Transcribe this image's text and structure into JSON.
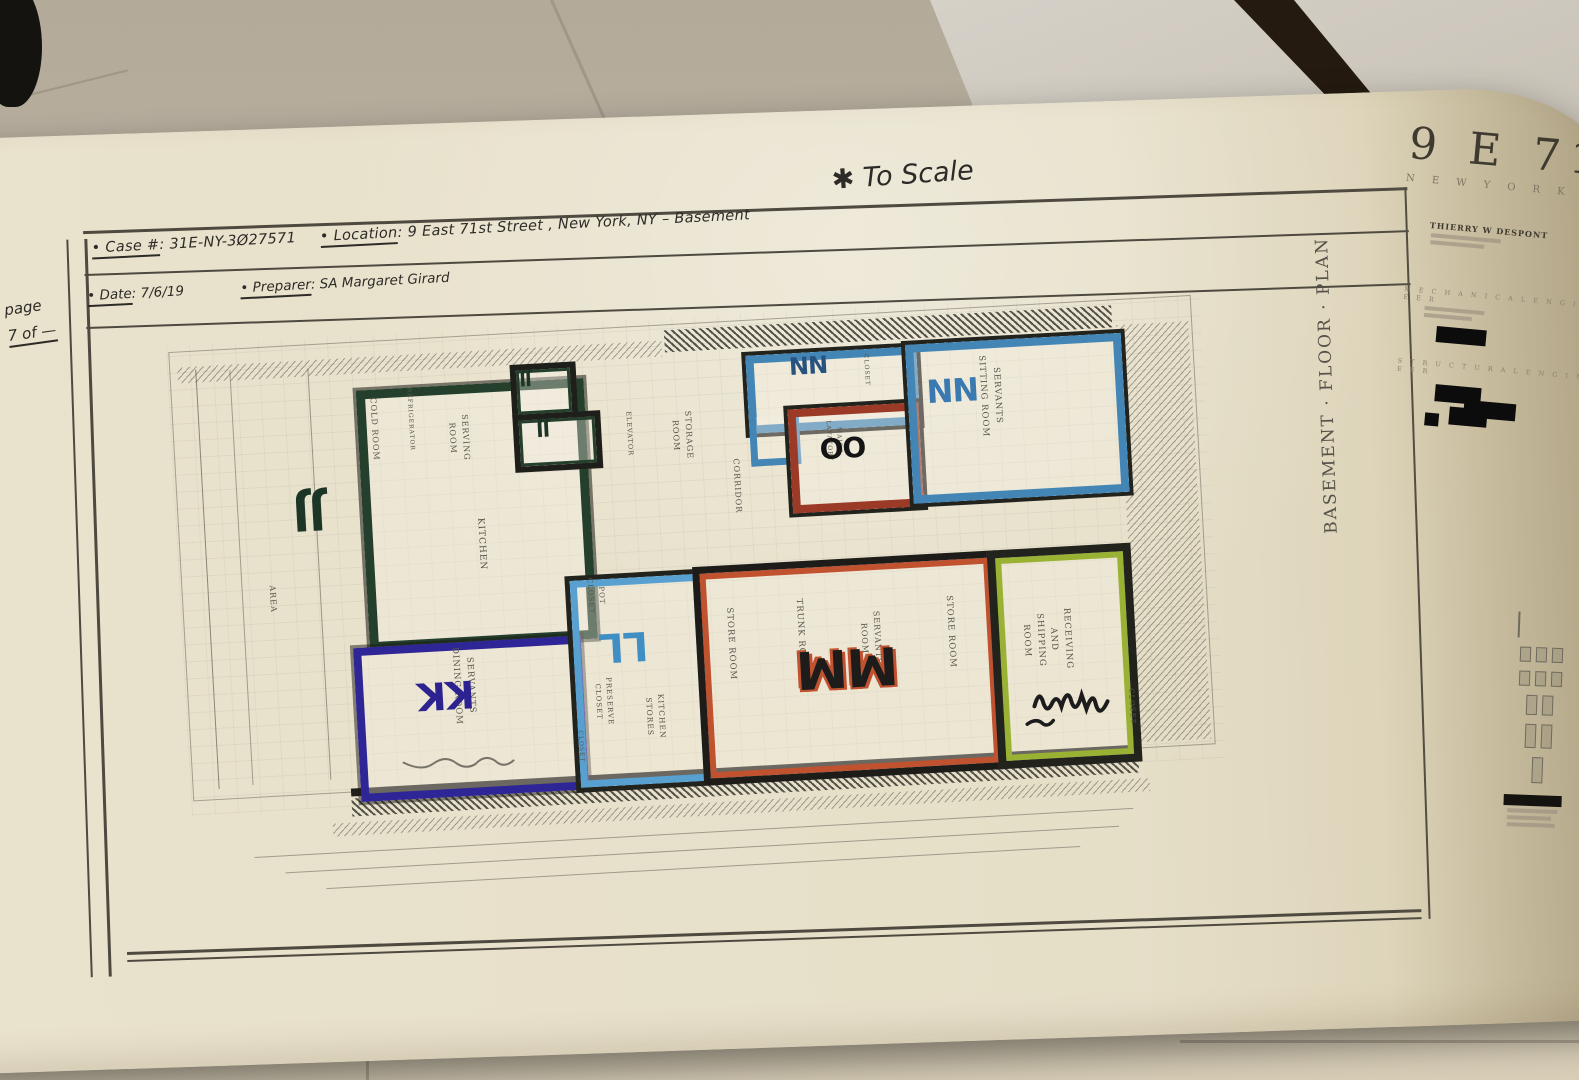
{
  "header": {
    "case_label": "• Case #",
    "case_value": ": 31E-NY-3Ø27571",
    "location_label": "• Location",
    "location_value": ": 9 East 71st Street , New York, NY – Basement",
    "date_label": "• Date",
    "date_value": ": 7/6/19",
    "preparer_label": "• Preparer",
    "preparer_value": ": SA Margaret Girard",
    "scale_note": "✱ To Scale",
    "page_label": "page",
    "page_value": "7 of —"
  },
  "plan": {
    "drawing_title": "BASEMENT · FLOOR · PLAN",
    "marked_rooms": [
      {
        "code": "JJ",
        "marker_color": "#24402d",
        "printed_rooms": [
          "COLD ROOM",
          "REFRIGERATOR",
          "SERVING\nROOM",
          "KITCHEN"
        ]
      },
      {
        "code": "KK",
        "marker_color": "#2e2596",
        "printed_rooms": [
          "SERVANTS\nDINING ROOM"
        ]
      },
      {
        "code": "LL",
        "marker_color": "#58a0cf",
        "printed_rooms": [
          "POT\nCLOSET",
          "PRESERVE\nCLOSET",
          "KITCHEN\nSTORES",
          "CLOSET"
        ]
      },
      {
        "code": "MM",
        "marker_color": "#c05230",
        "printed_rooms": [
          "STORE ROOM",
          "TRUNK ROOM",
          "SERVANTS\nROOM",
          "STORE ROOM"
        ]
      },
      {
        "code": "NN",
        "marker_color": "#4386b6",
        "printed_rooms": [
          "CLOSET"
        ]
      },
      {
        "code": "NN",
        "marker_color": "#4386b6",
        "printed_rooms": [
          "SERVANTS\nSITTING ROOM"
        ]
      },
      {
        "code": "OO",
        "marker_color": "#9c3a28",
        "printed_rooms": [
          "MAIDS\nLAVATORY"
        ]
      },
      {
        "code": "",
        "marker_color": "#9ab233",
        "printed_rooms": [
          "RECEIVING\nAND\nSHIPPING ROOM"
        ]
      }
    ],
    "other_labels": {
      "area": "AREA",
      "elevator": "ELEVATOR",
      "storage_room": "STORAGE\nROOM",
      "corridor": "CORRIDOR",
      "closet_right": "CLOSET"
    }
  },
  "title_block": {
    "project": "9 E 71",
    "city": "N E W   Y O R K",
    "architect": "THIERRY W DESPONT",
    "section_mechanical": "M E C H A N I C A L   E N G I N E E R",
    "section_structural": "S T R U C T U R A L   E N G I N E E R"
  }
}
